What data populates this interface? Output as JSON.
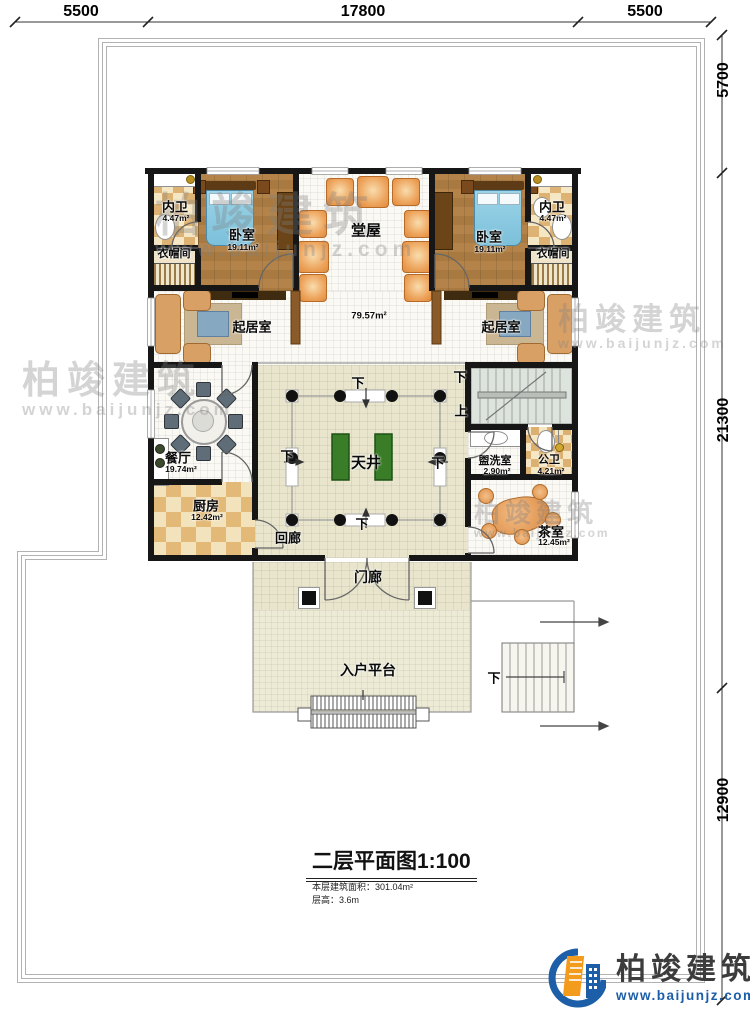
{
  "dimensions": {
    "top": [
      "5500",
      "17800",
      "5500"
    ],
    "right": [
      "5700",
      "21300",
      "12900"
    ]
  },
  "rooms": {
    "bath_left": {
      "name": "内卫",
      "area": "4.47m²"
    },
    "bedroom_left": {
      "name": "卧室",
      "area": "19.11m²"
    },
    "cloak_left": {
      "name": "衣帽间"
    },
    "hall": {
      "name": "堂屋"
    },
    "bedroom_right": {
      "name": "卧室",
      "area": "19.11m²"
    },
    "bath_right": {
      "name": "内卫",
      "area": "4.47m²"
    },
    "cloak_right": {
      "name": "衣帽间"
    },
    "living_left": {
      "name": "起居室"
    },
    "living_right": {
      "name": "起居室"
    },
    "living_area": "79.57m²",
    "dining": {
      "name": "餐厅",
      "area": "19.74m²"
    },
    "kitchen": {
      "name": "厨房",
      "area": "12.42m²"
    },
    "courtyard": {
      "name": "天井"
    },
    "washroom": {
      "name": "盥洗室",
      "area": "2.90m²"
    },
    "public_bath": {
      "name": "公卫",
      "area": "4.21m²"
    },
    "tearoom": {
      "name": "茶室",
      "area": "12.45m²"
    },
    "corridor": {
      "name": "回廊"
    },
    "porch": {
      "name": "门廊"
    },
    "platform": {
      "name": "入户平台"
    }
  },
  "stairs": {
    "down": "下",
    "up": "上"
  },
  "title_block": {
    "title": "二层平面图1:100",
    "area_note": "本层建筑面积：301.04m²",
    "height_note": "层高：3.6m"
  },
  "brand": {
    "name": "柏竣建筑",
    "url": "www.baijunjz.com"
  },
  "colors": {
    "wall": "#161616",
    "brand_blue": "#1c5fa8",
    "brand_orange": "#f29b1d",
    "planter_green": "#3a7d28",
    "bed_blue": "#8fd2e8"
  }
}
